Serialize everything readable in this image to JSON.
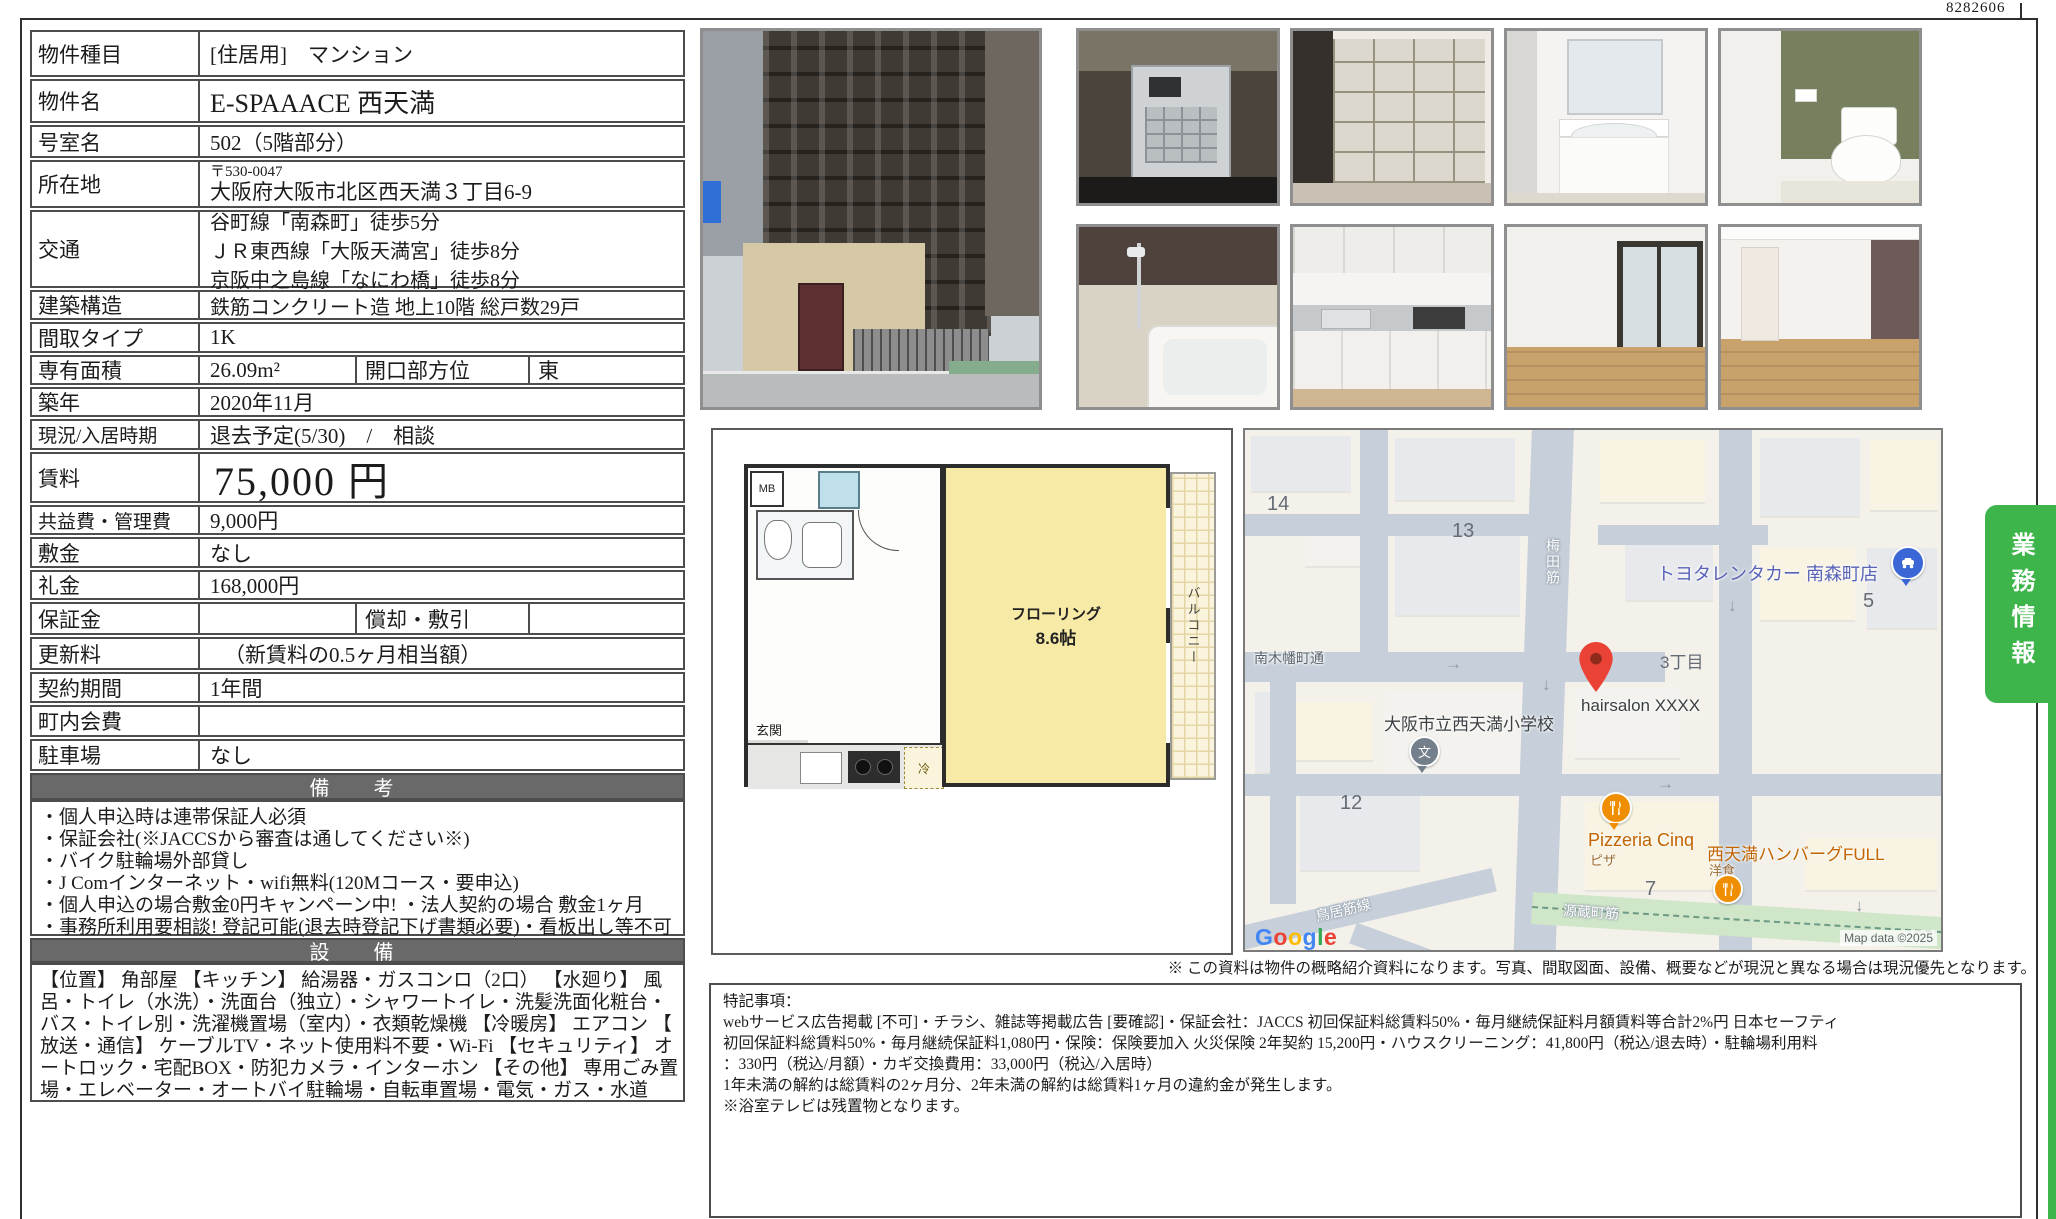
{
  "page": {
    "doc_number": "8282606"
  },
  "table": {
    "rows": [
      {
        "label": "物件種目",
        "value": "[住居用]　マンション"
      },
      {
        "label": "物件名",
        "value": "E-SPAAACE 西天満"
      },
      {
        "label": "号室名",
        "value": "502（5階部分）"
      },
      {
        "label": "所在地",
        "postal": "〒530-0047",
        "address": "大阪府大阪市北区西天満３丁目6-9"
      },
      {
        "label": "交通",
        "line1": "谷町線「南森町」徒歩5分",
        "line2": "ＪＲ東西線「大阪天満宮」徒歩8分",
        "line3": "京阪中之島線「なにわ橋」徒歩8分"
      },
      {
        "label": "建築構造",
        "value": "鉄筋コンクリート造 地上10階 総戸数29戸"
      },
      {
        "label": "間取タイプ",
        "value": "1K"
      },
      {
        "label": "専有面積",
        "value": "26.09m²",
        "sub_label": "開口部方位",
        "sub_value": "東"
      },
      {
        "label": "築年",
        "value": "2020年11月"
      },
      {
        "label": "現況/入居時期",
        "value": "退去予定(5/30)　/　相談"
      },
      {
        "label": "賃料",
        "value": "75,000 円"
      },
      {
        "label": "共益費・管理費",
        "value": "9,000円"
      },
      {
        "label": "敷金",
        "value": "なし"
      },
      {
        "label": "礼金",
        "value": "168,000円"
      },
      {
        "label": "保証金",
        "value": "",
        "sub_label": "償却・敷引",
        "sub_value": ""
      },
      {
        "label": "更新料",
        "value": "（新賃料の0.5ヶ月相当額）"
      },
      {
        "label": "契約期間",
        "value": "1年間"
      },
      {
        "label": "町内会費",
        "value": ""
      },
      {
        "label": "駐車場",
        "value": "なし"
      }
    ]
  },
  "sections": {
    "remarks_title": "備　考",
    "remarks": [
      "・個人申込時は連帯保証人必須",
      "・保証会社(※JACCSから審査は通してください※)",
      "・バイク駐輪場外部貸し",
      "・J Comインターネット・wifi無料(120Mコース・要申込)",
      "・個人申込の場合敷金0円キャンペーン中! ・法人契約の場合 敷金1ヶ月",
      "・事務所利用要相談! 登記可能(退去時登記下げ書類必要)・看板出し等不可"
    ],
    "equipment_title": "設　備",
    "equipment": [
      "【位置】 角部屋 【キッチン】 給湯器・ガスコンロ（2口） 【水廻り】 風",
      "呂・トイレ（水洗）・洗面台（独立）・シャワートイレ・洗髪洗面化粧台・",
      "バス・トイレ別・洗濯機置場（室内）・衣類乾燥機 【冷暖房】 エアコン 【",
      "放送・通信】 ケーブルTV・ネット使用料不要・Wi-Fi 【セキュリティ】 オ",
      "ートロック・宅配BOX・防犯カメラ・インターホン 【その他】 専用ごみ置",
      "場・エレベーター・オートバイ駐輪場・自転車置場・電気・ガス・水道"
    ]
  },
  "floorplan": {
    "mb": "MB",
    "entrance": "玄関",
    "room_name": "フローリング",
    "room_size": "8.6帖",
    "balcony": "バルコニー",
    "fridge": "冷"
  },
  "map": {
    "labels": {
      "n14": "14",
      "n13": "13",
      "n12": "12",
      "n7": "7",
      "n5": "5",
      "chome": "3丁目",
      "toyota": "トヨタレンタカー 南森町店",
      "hairsalon": "hairsalon XXXX",
      "school": "大阪市立西天満小学校",
      "school_glyph": "文",
      "pizzeria": "Pizzeria Cinq",
      "pizzeria_sub": "ピザ",
      "hamburg": "西天満ハンバーグFULL",
      "hamburg_sub": "洋食",
      "road_minamikobata": "南木幡町通",
      "road_genzo": "源蔵町筋",
      "road_torii": "鳥居筋線",
      "road_vertical": "梅田筋",
      "arrow_right": "→",
      "arrow_down": "↓"
    },
    "google_letters": [
      "G",
      "o",
      "o",
      "g",
      "l",
      "e"
    ],
    "attribution": "Map data ©2025",
    "colors": {
      "pin_red": "#EA4335",
      "pin_blue": "#3a66d6",
      "pin_orange": "#ef8e00",
      "pin_gray": "#737f8b",
      "accent_green": "#3eb54a"
    }
  },
  "note": "※ この資料は物件の概略紹介資料になります。写真、間取図面、設備、概要などが現況と異なる場合は現況優先となります。",
  "tokki": {
    "lines": [
      "特記事項：",
      "webサービス広告掲載 [不可]・チラシ、雑誌等掲載広告 [要確認]・保証会社：JACCS 初回保証料総賃料50%・毎月継続保証料月額賃料等合計2%円 日本セーフティ",
      "初回保証料総賃料50%・毎月継続保証料1,080円・保険：保険要加入 火災保険 2年契約 15,200円・ハウスクリーニング：41,800円（税込/退去時）・駐輪場利用料",
      "：330円（税込/月額）・カギ交換費用：33,000円（税込/入居時）",
      "1年未満の解約は総賃料の2ヶ月分、2年未満の解約は総賃料1ヶ月の違約金が発生します。",
      "※浴室テレビは残置物となります。"
    ]
  },
  "tab": {
    "label": "業務情報"
  }
}
